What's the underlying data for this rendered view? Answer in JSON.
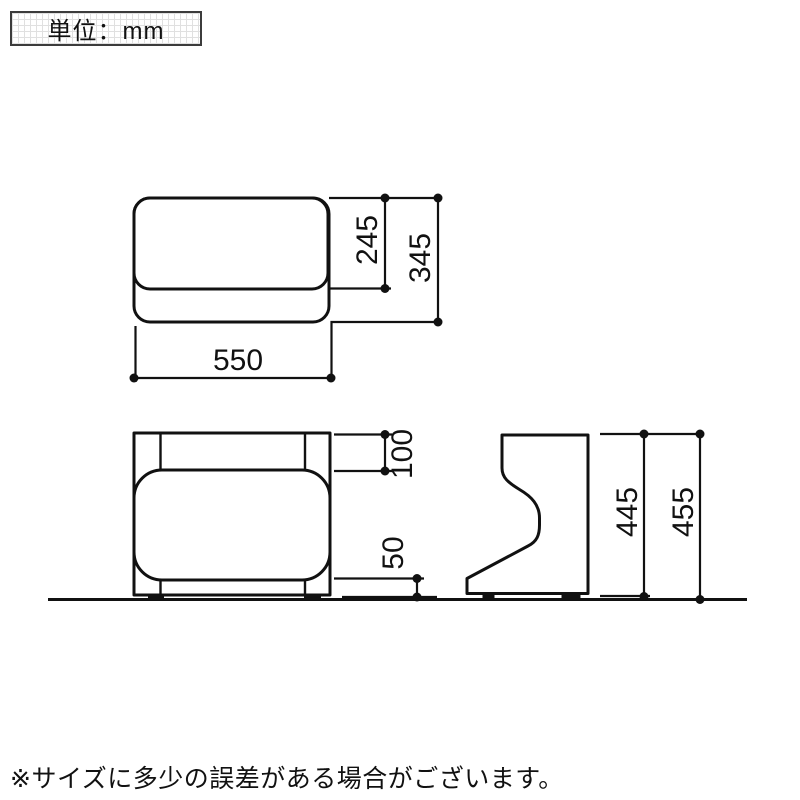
{
  "unit_label": "単位：mm",
  "footnote": "※サイズに多少の誤差がある場合がございます。",
  "dims": {
    "top_width": "550",
    "seat_depth": "245",
    "total_depth": "345",
    "top_frame_height": "100",
    "bottom_clearance": "50",
    "body_height": "445",
    "total_height": "455"
  },
  "colors": {
    "line": "#111111",
    "background": "#ffffff",
    "grid_line": "#e0e0e0"
  }
}
